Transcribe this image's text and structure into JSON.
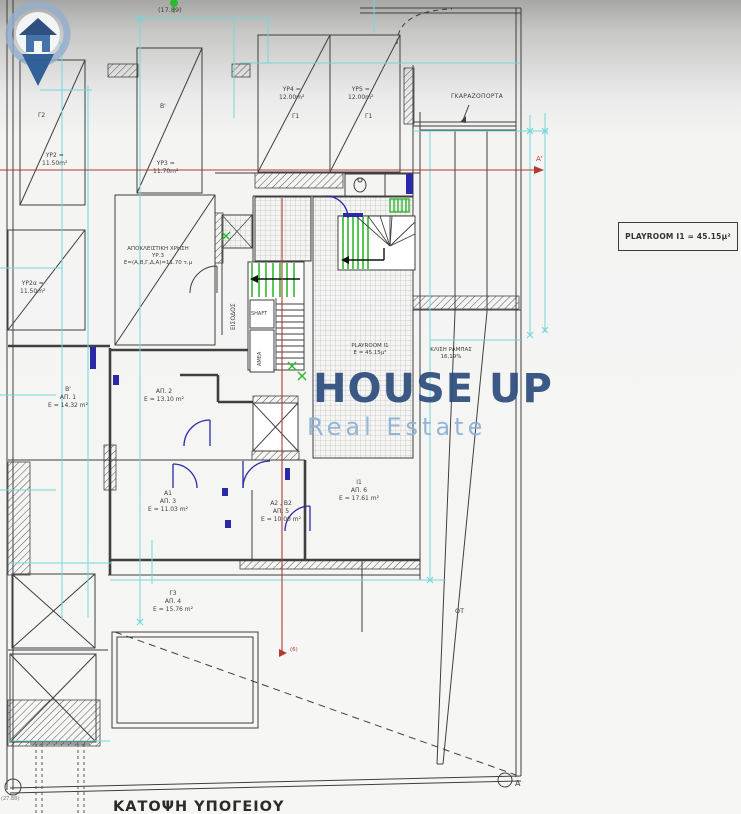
{
  "colors": {
    "dimension_cyan": "#72d8d8",
    "section_red": "#b23b33",
    "stair_green": "#2eb82e",
    "door_navy": "#2a2aa8",
    "logo_dark_blue": "#2f4e7e",
    "logo_light_blue": "#8fb3d4"
  },
  "plan_title": "ΚΑΤΟΨΗ ΥΠΟΓΕΙΟΥ",
  "elevation_note": "(17.89)",
  "corner_note": "(27.88)",
  "garage_door_label": "ΓΚΑΡΑΖΟΠΟΡΤΑ",
  "info_box": {
    "label": "PLAYROOM  Ι1 = 45.15μ²"
  },
  "watermark": {
    "title": "HOUSE UP",
    "subtitle": "Real Estate"
  },
  "parking_spots": [
    {
      "code": "Γ2",
      "name": "ΥΡ2 =",
      "area": "11.50m²"
    },
    {
      "code": "Β'",
      "name": "ΥΡ3 =",
      "area": "11.70m²"
    },
    {
      "code": "Γ1",
      "name": "ΥΡ4 =",
      "area": "12.00m²"
    },
    {
      "code": "Γ1",
      "name": "ΥΡ5 =",
      "area": "12.00m²"
    },
    {
      "code": "",
      "name": "ΥΡ2α =",
      "area": "11.50m²"
    }
  ],
  "exclusive_use": {
    "line1": "ΑΠΟΚΛΕΙΣΤΙΚΗ ΧΡΗΣΗ",
    "line2": "ΥΡ.3",
    "line3": "Ε=(Α,Β,Γ,Δ,Α)=11.70 τ.μ"
  },
  "storage_rooms": [
    {
      "code": "Β'",
      "name": "ΑΠ. 1",
      "area": "Ε = 14.32 m²"
    },
    {
      "code": "",
      "name": "ΑΠ. 2",
      "area": "Ε = 13.10 m²"
    },
    {
      "code": "Α1",
      "name": "ΑΠ. 3",
      "area": "Ε = 11.03 m²"
    },
    {
      "code": "Γ3",
      "name": "ΑΠ. 4",
      "area": "Ε = 15.76 m²"
    },
    {
      "code": "Α2 , Β2",
      "name": "ΑΠ. 5",
      "area": "Ε = 10.00 m²"
    },
    {
      "code": "Ι1",
      "name": "ΑΠ. 6",
      "area": "Ε = 17.61 m²"
    }
  ],
  "plan_labels": {
    "entrance": "ΕΙΣΟΔΟΣ",
    "shaft": "SHAFT",
    "amea": "ΑΜΕΑ",
    "playroom_name": "PLAYROOM Ι1",
    "playroom_area": "Ε = 45.15μ²",
    "ramp_slope_label": "ΚΛΙΣΗ ΡΑΜΠΑΣ",
    "ramp_slope_value": "16,19%",
    "block_label": "ΟΤ",
    "section_top": "Α'",
    "section_mid": "(6)",
    "section_bottom": "Α"
  }
}
